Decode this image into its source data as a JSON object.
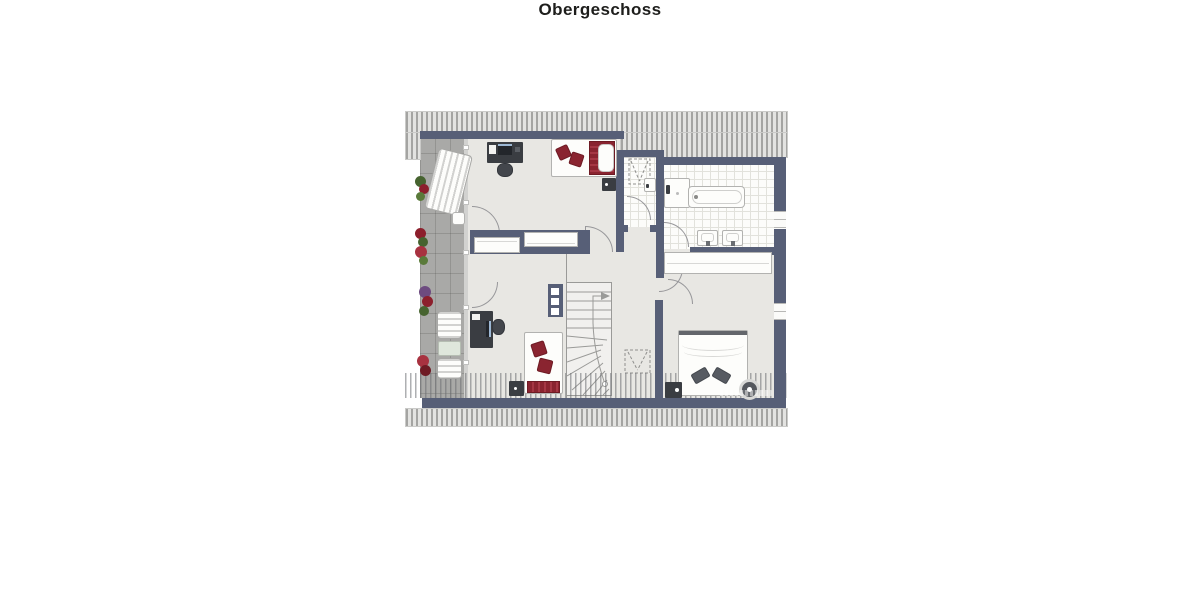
{
  "title": "Obergeschoss",
  "disclaimer": "Exposéplan, nicht maßstäblich",
  "plan": {
    "type": "floor-plan",
    "floor_shown": "Obergeschoss",
    "labels_visible": false,
    "colors": {
      "wall": "#575f77",
      "interior_floor": "#e8e7e3",
      "bathroom_tile": "#fcfcfa",
      "balcony_tile": "#a9a9a7",
      "roof_hatch_line": "#a4a4a2",
      "accent_maroon": "#8a2430",
      "dark_furniture": "#3a3d42"
    },
    "objects": [
      "roof-hatching-top",
      "roof-hatching-bottom",
      "balcony",
      "sun-lounger",
      "balcony-side-table",
      "balcony-chairs",
      "balcony-table",
      "planters",
      "desk-with-monitor",
      "office-chair",
      "single-bed-with-red-pillows",
      "nightstand",
      "built-in-wardrobes",
      "winder-staircase",
      "stair-direction-arrow",
      "wall-shelf",
      "dashed-roof-window-markers",
      "shower",
      "bathtub",
      "double-washbasin",
      "hallway-closet",
      "double-bed-with-dark-pillows",
      "round-stool",
      "door-swing-arcs",
      "windows",
      "glass-balcony-front"
    ]
  }
}
